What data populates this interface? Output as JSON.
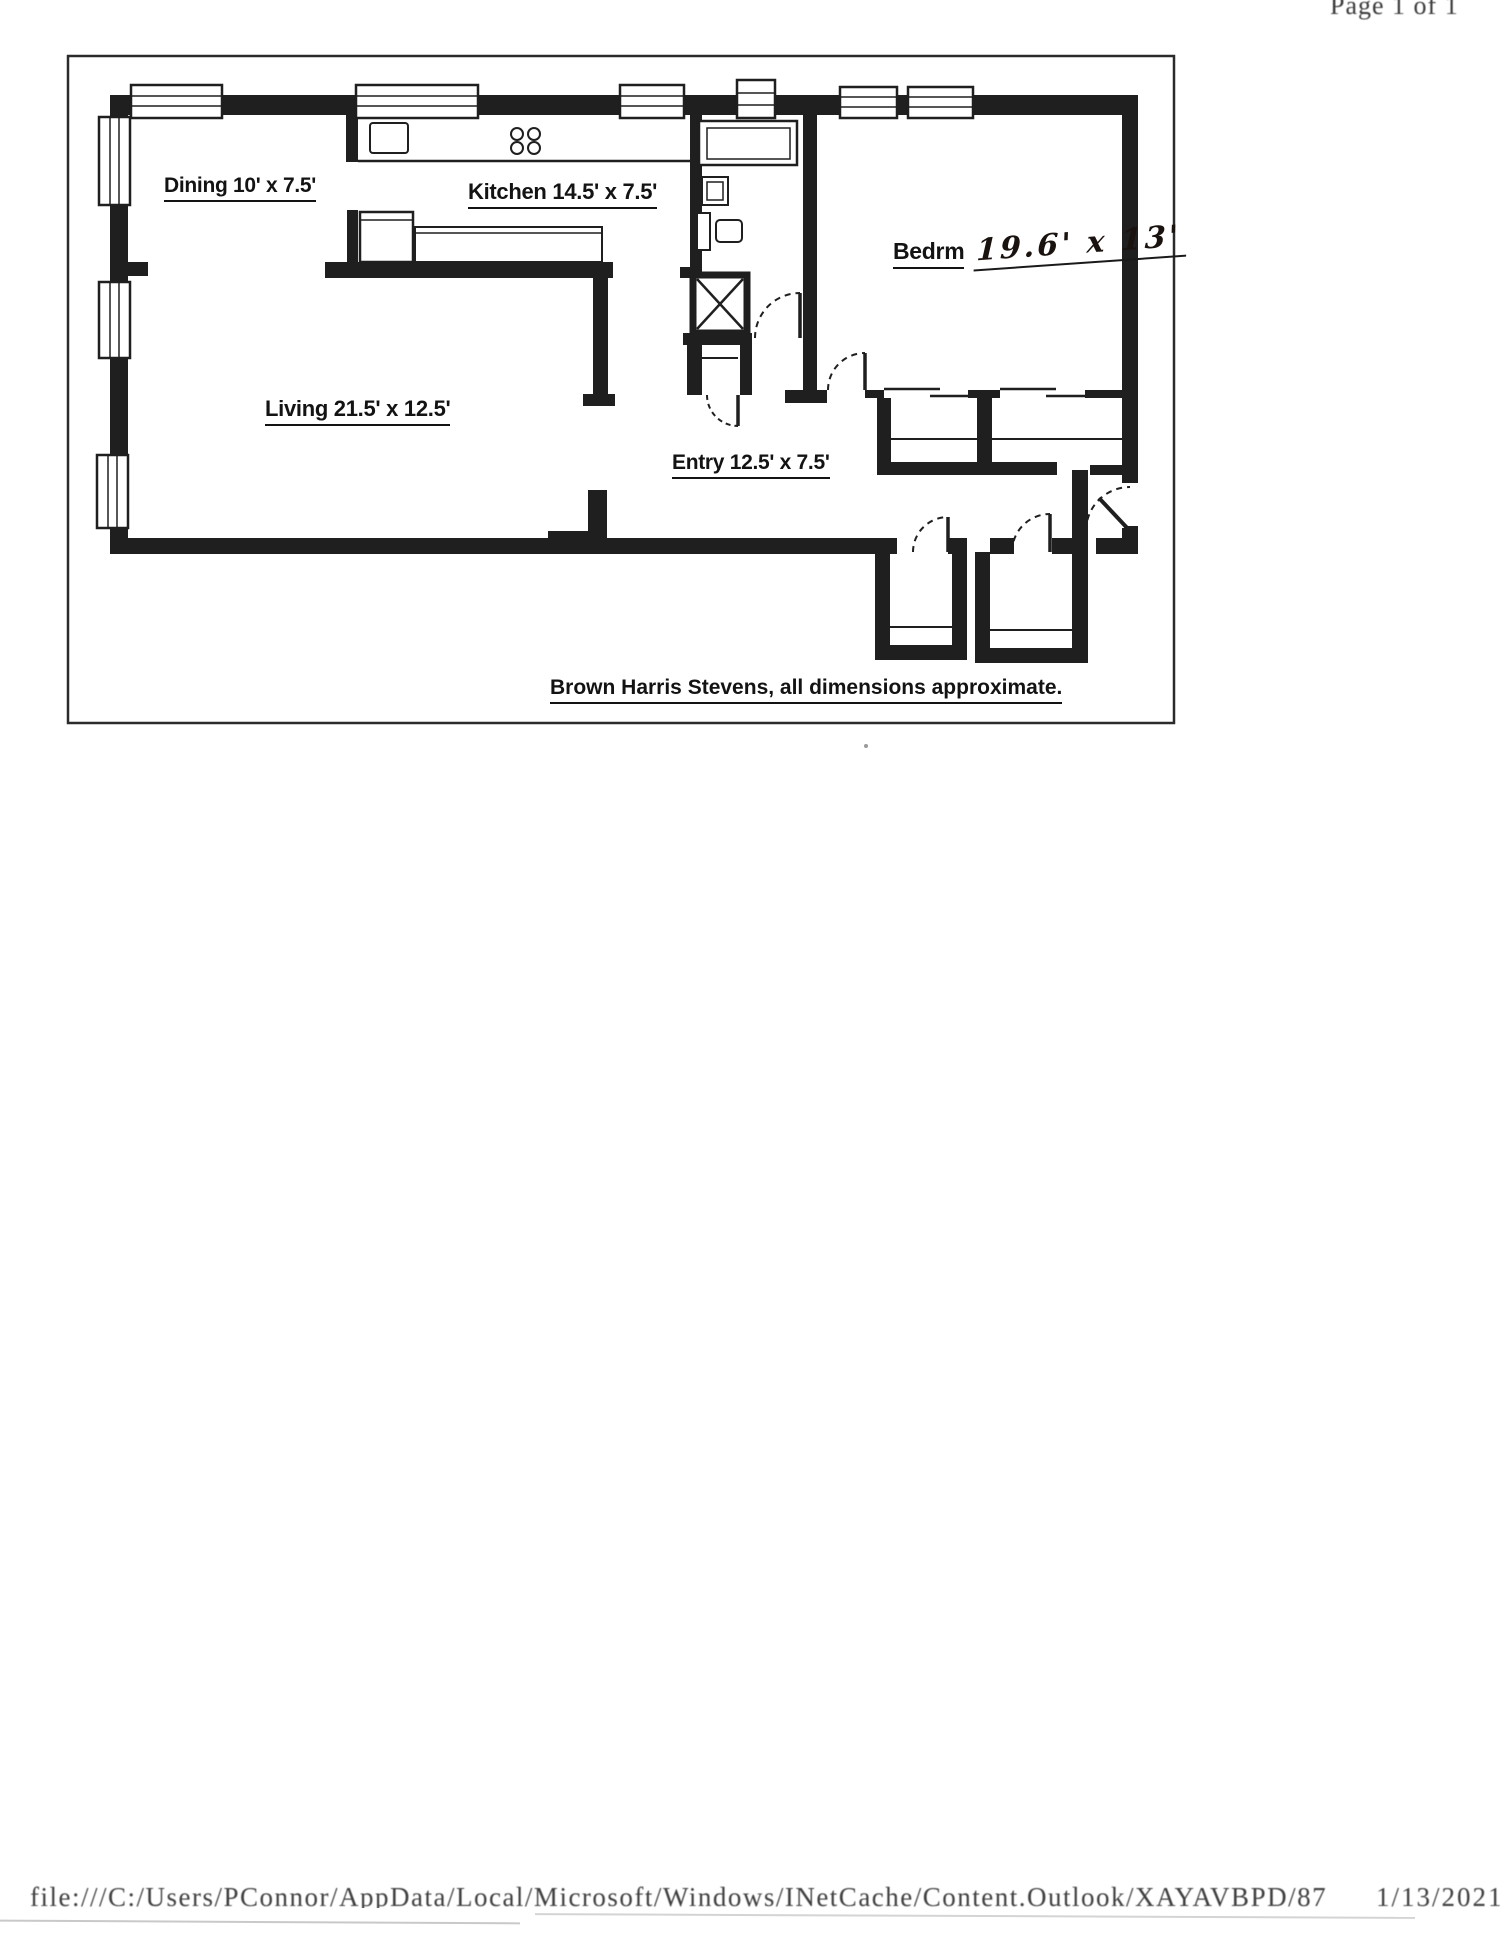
{
  "page": {
    "header": {
      "page_indicator": "Page 1 of 1"
    },
    "footer": {
      "file_path": "file:///C:/Users/PConnor/AppData/Local/Microsoft/Windows/INetCache/Content.Outlook/XAYAVBPD/87",
      "date": "1/13/2021"
    }
  },
  "floor_plan": {
    "caption": "Brown Harris Stevens, all dimensions approximate.",
    "rooms": {
      "dining": {
        "label": "Dining 10' x 7.5'"
      },
      "kitchen": {
        "label": "Kitchen 14.5' x 7.5'"
      },
      "bedroom": {
        "label": "Bedrm",
        "handwritten_dimensions": "19.6' x 13'"
      },
      "living": {
        "label": "Living 21.5' x 12.5'"
      },
      "entry": {
        "label": "Entry 12.5' x 7.5'"
      }
    },
    "fixtures": {
      "bathroom": [
        "bathtub",
        "sink",
        "toilet"
      ],
      "kitchen": [
        "sink",
        "stove-4-burner",
        "counter",
        "appliance"
      ],
      "other": [
        "elevator-shaft",
        "closets-with-shelves",
        "windows",
        "swing-doors",
        "entry-door"
      ]
    },
    "colors": {
      "wall": "#1f1f1f",
      "paper": "#ffffff",
      "ink": "#131313"
    }
  }
}
